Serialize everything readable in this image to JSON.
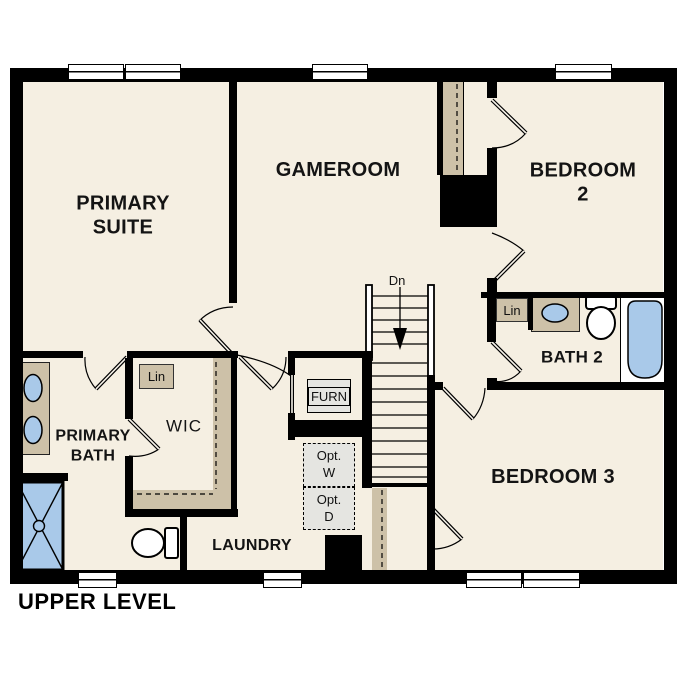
{
  "title": "UPPER LEVEL",
  "rooms": {
    "primary_suite": "PRIMARY\nSUITE",
    "gameroom": "GAMEROOM",
    "bedroom2": "BEDROOM 2",
    "bath2": "BATH 2",
    "bedroom3": "BEDROOM 3",
    "primary_bath": "PRIMARY\nBATH",
    "wic": "WIC",
    "laundry": "LAUNDRY"
  },
  "annotations": {
    "linen_wic": "Lin",
    "linen_bath2": "Lin",
    "furnace": "FURN",
    "optional_washer": "Opt.\nW",
    "optional_dryer": "Opt.\nD",
    "stairs_down": "Dn"
  },
  "colors": {
    "floor": "#f5efe2",
    "wall": "#000000",
    "casework_tan": "#cdc1a8",
    "fixture_blue": "#a9c9e9",
    "optional_gray": "#e5e5e1"
  }
}
